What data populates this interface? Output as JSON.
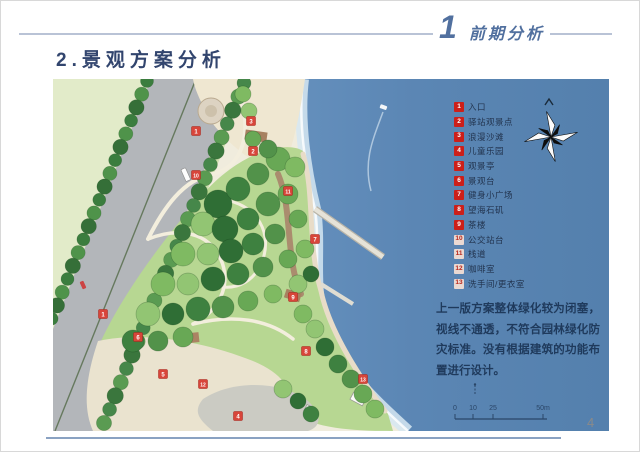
{
  "colors": {
    "accent_blue": "#51709f",
    "title_navy": "#32456e",
    "legend_red": "#cc1f1a",
    "text_navy": "#1f3a5c",
    "sea_blue": "#5b86b4",
    "footer_line": "#8aa2c2"
  },
  "header": {
    "section_number": "1",
    "section_title": "前期分析"
  },
  "page": {
    "title": "2.景观方案分析",
    "page_number": "4"
  },
  "legend": {
    "items": [
      {
        "num": "1",
        "label": "入口"
      },
      {
        "num": "2",
        "label": "驿站观景点"
      },
      {
        "num": "3",
        "label": "浪漫沙滩"
      },
      {
        "num": "4",
        "label": "儿童乐园"
      },
      {
        "num": "5",
        "label": "观景亭"
      },
      {
        "num": "6",
        "label": "景观台"
      },
      {
        "num": "7",
        "label": "健身小广场"
      },
      {
        "num": "8",
        "label": "望海石矶"
      },
      {
        "num": "9",
        "label": "茶楼"
      },
      {
        "num": "10",
        "label": "公交站台"
      },
      {
        "num": "11",
        "label": "栈道"
      },
      {
        "num": "12",
        "label": "咖啡室"
      },
      {
        "num": "13",
        "label": "洗手间/更衣室"
      }
    ]
  },
  "map": {
    "markers": [
      {
        "num": "1",
        "x": 143,
        "y": 52
      },
      {
        "num": "3",
        "x": 198,
        "y": 42
      },
      {
        "num": "10",
        "x": 143,
        "y": 96
      },
      {
        "num": "2",
        "x": 200,
        "y": 72
      },
      {
        "num": "11",
        "x": 235,
        "y": 112
      },
      {
        "num": "7",
        "x": 262,
        "y": 160
      },
      {
        "num": "9",
        "x": 240,
        "y": 218
      },
      {
        "num": "1",
        "x": 50,
        "y": 235
      },
      {
        "num": "6",
        "x": 85,
        "y": 258
      },
      {
        "num": "5",
        "x": 110,
        "y": 295
      },
      {
        "num": "12",
        "x": 150,
        "y": 305
      },
      {
        "num": "4",
        "x": 185,
        "y": 337
      },
      {
        "num": "8",
        "x": 253,
        "y": 272
      },
      {
        "num": "13",
        "x": 310,
        "y": 300
      }
    ]
  },
  "annotation": {
    "text": "上一版方案整体绿化较为闭塞，视线不通透，不符合园林绿化防灾标准。没有根据建筑的功能布置进行设计。"
  },
  "scale_bar": {
    "labels": [
      "0",
      "10",
      "25",
      "50m"
    ]
  }
}
